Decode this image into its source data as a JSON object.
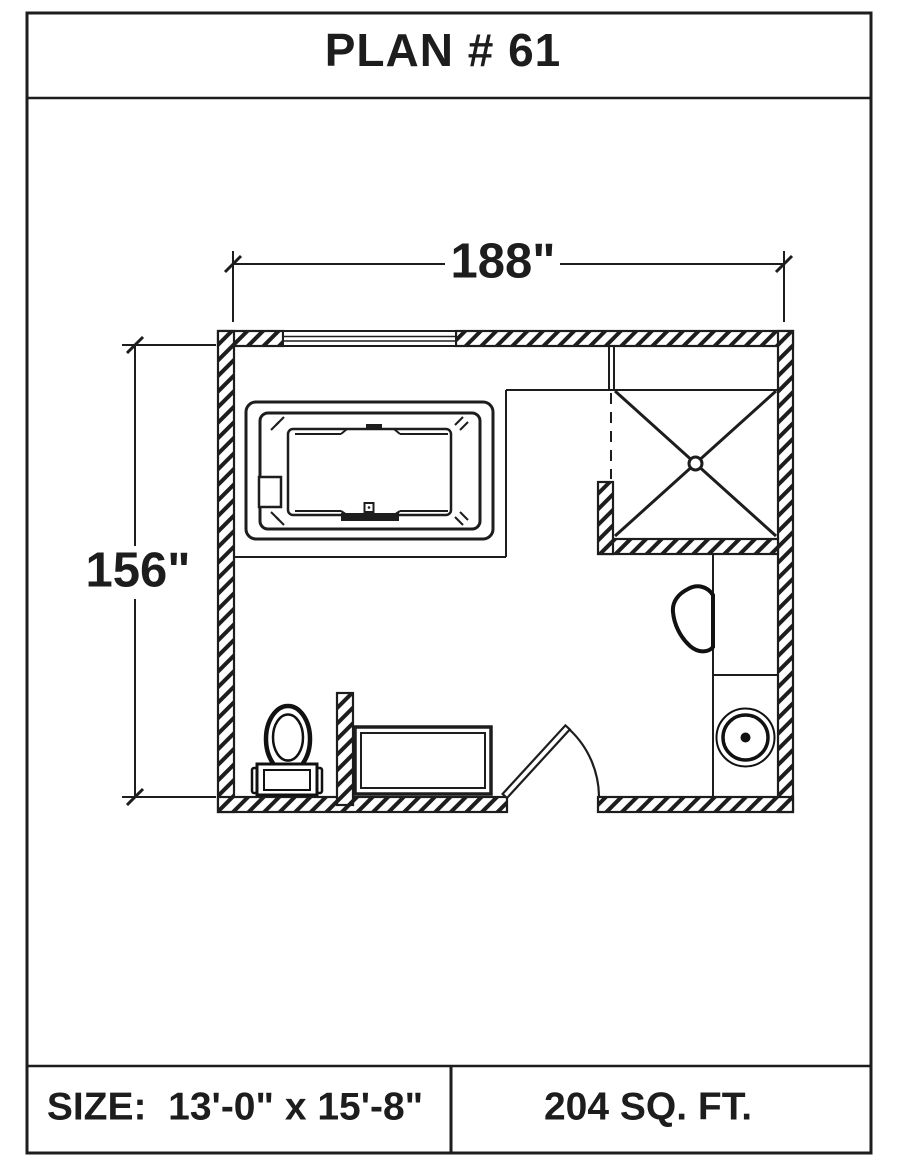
{
  "title": "PLAN # 61",
  "plan": {
    "width_dimension": "188\"",
    "height_dimension": "156\"",
    "fixtures": [
      "jetted-bathtub",
      "corner-shower",
      "toilet",
      "storage-cabinet",
      "entry-door",
      "wall-hung-toilet",
      "round-sink-vanity",
      "window"
    ]
  },
  "footer": {
    "size": "SIZE:  13'-0\" x 15'-8\"",
    "area": "204 SQ. FT."
  },
  "colors": {
    "line": "#1d1d1d",
    "background": "#ffffff"
  }
}
